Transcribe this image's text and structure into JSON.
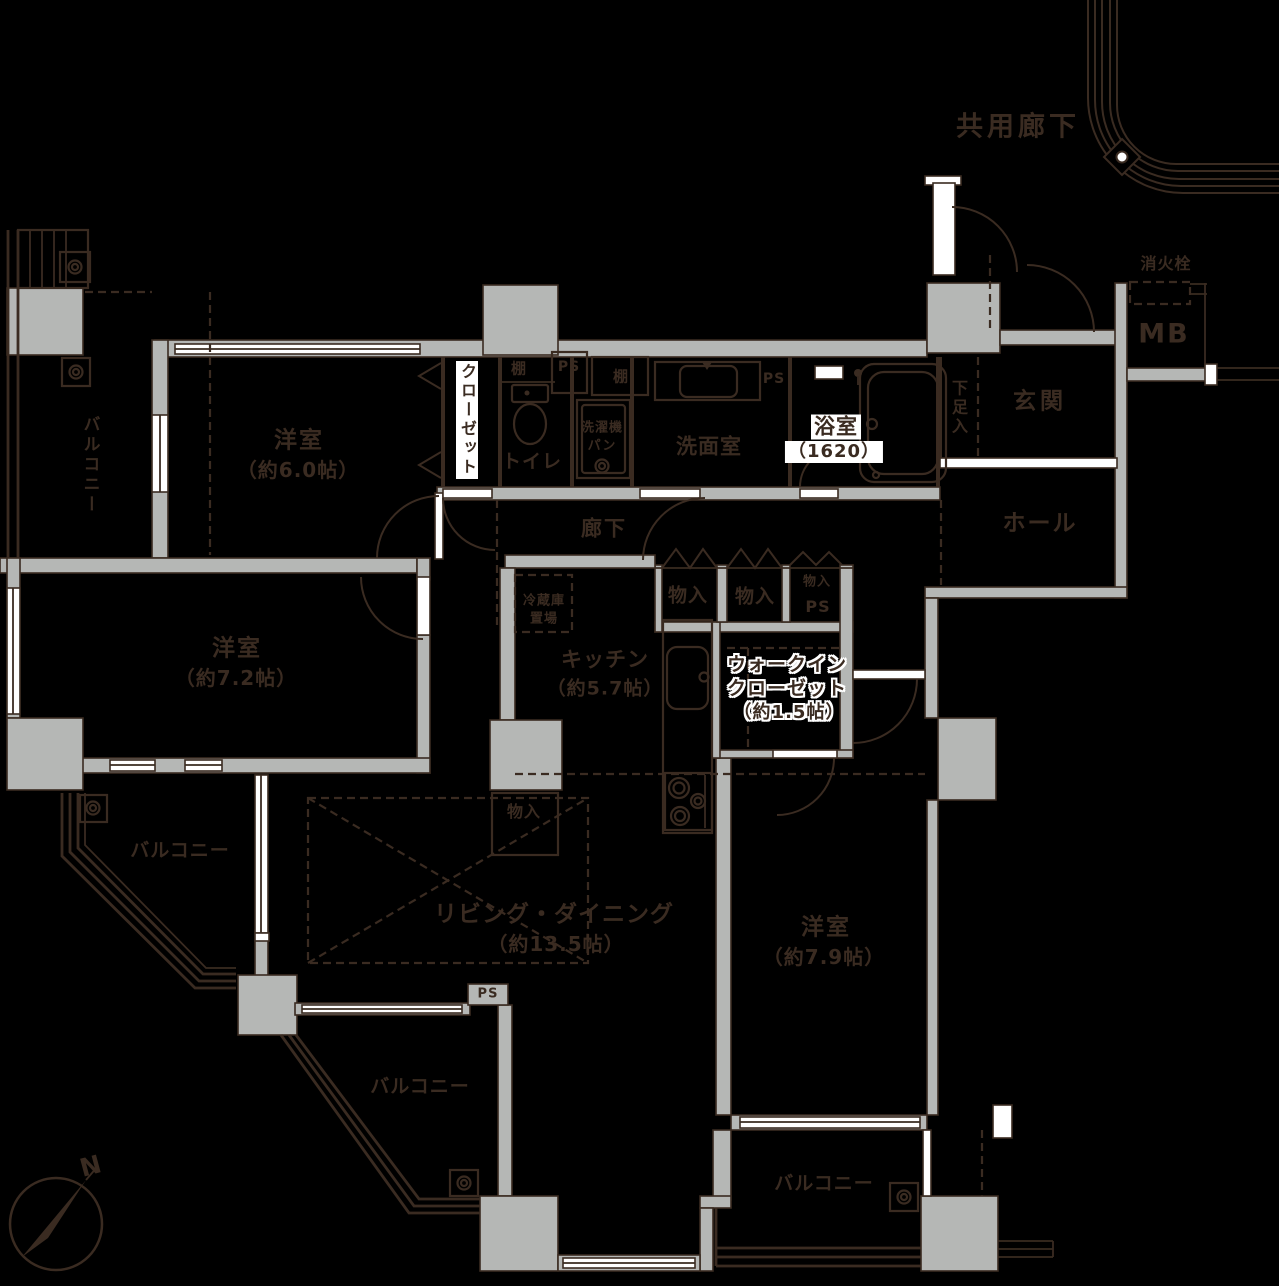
{
  "palette": {
    "background": "#000000",
    "line": "#3a2b21",
    "wall": "#b5b7b5",
    "white": "#ffffff"
  },
  "common": {
    "corridor": "共用廊下",
    "fire_hydrant": "消火栓",
    "meter_box": "MB"
  },
  "entry": {
    "genkan": "玄関",
    "shoe_box": "下足入",
    "hall": "ホール",
    "corridor": "廊下"
  },
  "sanitary": {
    "bath": "浴室",
    "bath_size": "（1620）",
    "washroom": "洗面室",
    "washer_top": "洗濯機",
    "washer_bottom": "パン",
    "toilet": "トイレ",
    "shelf_a": "棚",
    "shelf_b": "棚"
  },
  "ps": {
    "a": "PS",
    "b": "PS",
    "c": "PS",
    "d": "PS"
  },
  "storage": {
    "closet": "クローゼット",
    "monoire_a": "物入",
    "monoire_b": "物入",
    "monoire_c": "物入",
    "monoire_d": "物入",
    "wic_line1": "ウォークイン",
    "wic_line2": "クローゼット",
    "wic_size": "（約1.5帖）",
    "fridge_top": "冷蔵庫",
    "fridge_bottom": "置場"
  },
  "rooms": {
    "bedroom1_name": "洋室",
    "bedroom1_size": "（約6.0帖）",
    "bedroom2_name": "洋室",
    "bedroom2_size": "（約7.2帖）",
    "bedroom3_name": "洋室",
    "bedroom3_size": "（約7.9帖）",
    "living_name": "リビング・ダイニング",
    "living_size": "（約13.5帖）",
    "kitchen_name": "キッチン",
    "kitchen_size": "（約5.7帖）"
  },
  "balcony": {
    "a": "バルコニー",
    "b": "バルコニー",
    "c": "バルコニー",
    "d": "バルコニー"
  },
  "compass": {
    "north": "N"
  }
}
